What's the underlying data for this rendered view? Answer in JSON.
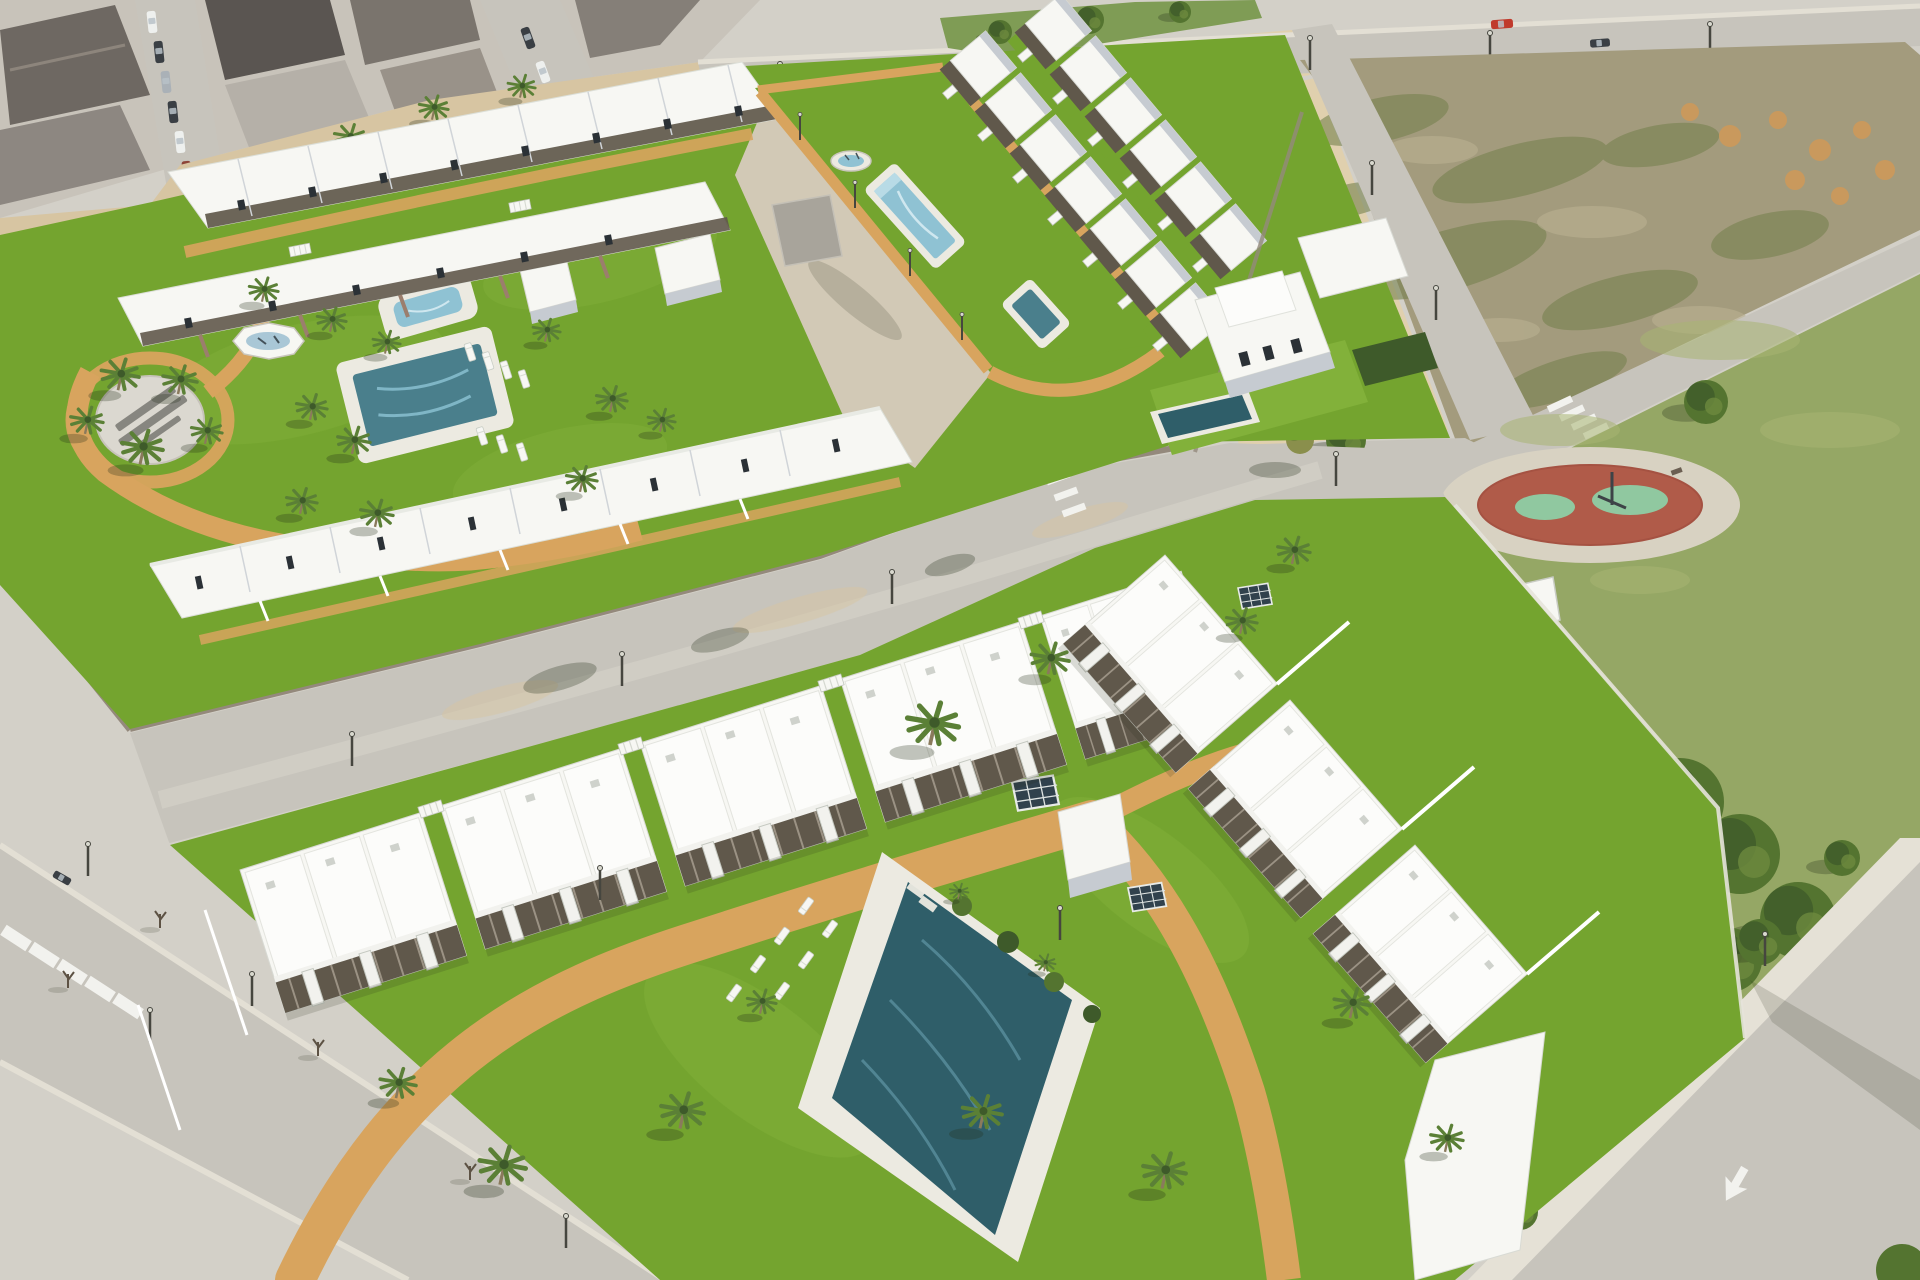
{
  "scene": {
    "title": "Aerial 3D render of a new-build white residential development with communal gardens and pools, next to an existing town, a vacant plot and a public park",
    "view": "oblique aerial, daytime"
  },
  "areas": {
    "town": "existing town blocks with parked cars",
    "top_road": "avenue along the top with a red car",
    "median": "green road median with trees",
    "vacant_lot": "fenced vacant dirt plot with scrub and earth mounds",
    "park": "public park with pine trees and round playground",
    "playground": "red circular playground with green safety patches",
    "middle_road": "street between the two phases of the development",
    "road_d": "street at lower left with young trees and lampposts",
    "road_c": "avenue at lower right with a white lane arrow",
    "upper_dev": "phase with terraced houses, logo plaza, fountain, spa, family pool and lap-pool lawn",
    "lower_dev": "phase with apartment blocks around a large communal pool",
    "villa": "detached two-storey villa with private plunge pool",
    "logo_plaza": "paved circular plaza with developer logo (illegible)",
    "main_pool": "large communal swimming pool with sun loungers",
    "lap_pool": "elongated pool on the long lawn strip",
    "fountain": "round splash fountain",
    "octagon_fountain": "octagonal white fountain on the lawn",
    "spa": "rounded spa pool",
    "family_pool": "rectangular family pool",
    "plunge_pool": "small square plunge pool"
  },
  "palette": {
    "road": "#d3d0c8",
    "roadmid": "#c7c4bc",
    "side": "#e5e1d6",
    "sand": "#d7c5a2",
    "sand2": "#e0d0ae",
    "sandy": "#d2c9b6",
    "path": "#d8a45e",
    "lot": "#a39b7d",
    "scrub": "#77824f",
    "patch": "#b8af90",
    "mound": "#c9995d",
    "grass": "#74a42f",
    "grass2": "#82b13a",
    "park": "#95a765",
    "lawn2": "#a8b573",
    "tdark": "#3e5a2a",
    "tmid": "#547430",
    "palm": "#5b8036",
    "white": "#f7f7f3",
    "white2": "#f2f2ee",
    "roof": "#fcfcfa",
    "wshade": "#c6cbd1",
    "wdark": "#a9afb7",
    "perg": "#60584b",
    "win": "#2b3136",
    "stone": "#94897c",
    "stoneL": "#cec3b2",
    "brick": "#9b7e6d",
    "poolL": "#8fc2d3",
    "poolT": "#4a7f8c",
    "poolD": "#2f5e69",
    "deck": "#eceae1",
    "plaza": "#dbd8d0",
    "pred": "#b05b49",
    "pgreen": "#90c8a0",
    "cred": "#c03a2c",
    "cdark": "#3a3f44",
    "csilver": "#aab1b7",
    "cwhite": "#eef0ee",
    "shadow": "rgba(35,45,25,0.28)",
    "shadow2": "rgba(35,45,25,0.16)",
    "lamp": "#46463f",
    "lamphead": "#d9d9cf",
    "trunk": "#8a7a5c",
    "sapling": "#5d5244",
    "olive": "#8a8f4c",
    "glass": "#31424d",
    "wall": "#e6e3da"
  }
}
